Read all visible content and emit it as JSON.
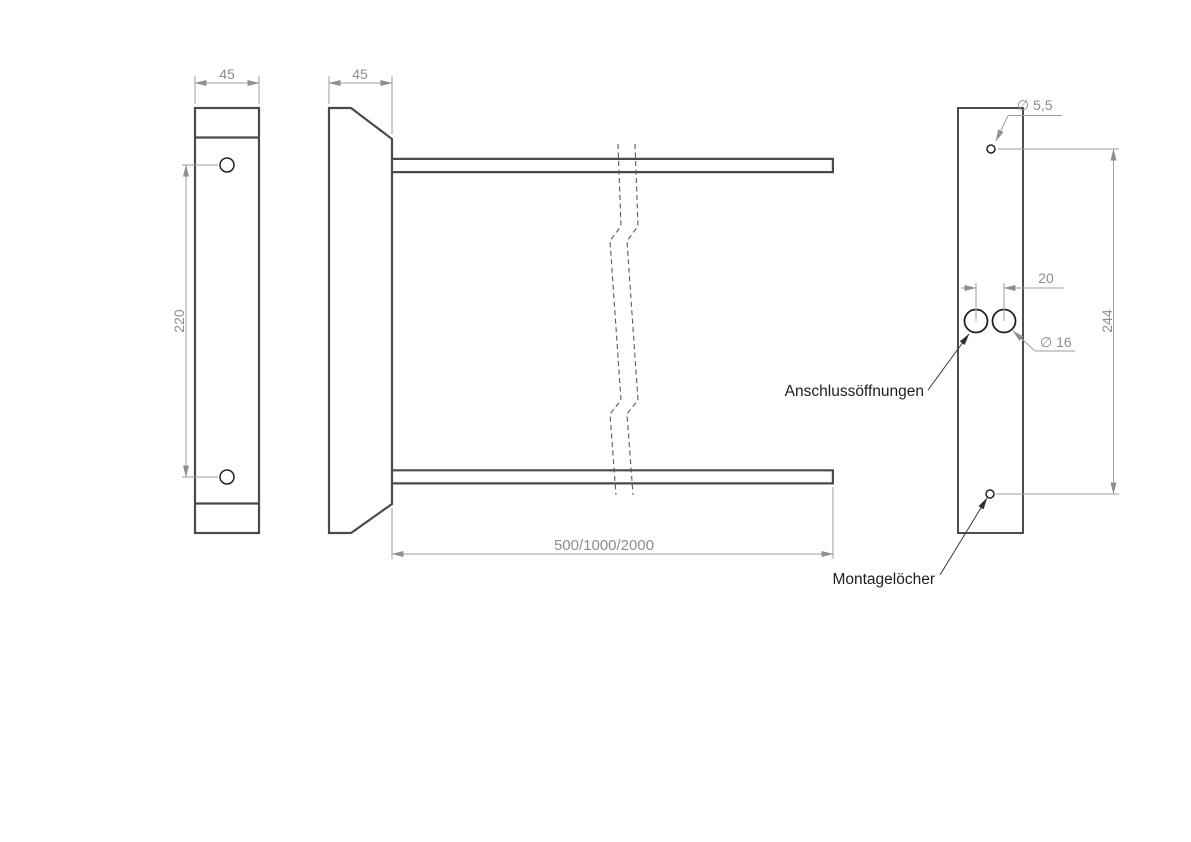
{
  "title": "technical-drawing-wall-bracket",
  "colors": {
    "background": "#ffffff",
    "part_outline": "#4a4a4a",
    "rear_outline": "#2e2e2e",
    "hole_stroke": "#222222",
    "dim_line": "#9e9e9e",
    "dim_text": "#8c8c8c",
    "break_line": "#5a5a5a",
    "callout_text": "#1d1d1d",
    "callout_line": "#3a3a3a"
  },
  "views": {
    "left_profile": {
      "width_dim": "45",
      "hole_spacing_dim": "220"
    },
    "side": {
      "depth_dim": "45",
      "length_dim": "500/1000/2000"
    },
    "rear_panel": {
      "mount_hole_dia_dim": "∅ 5,5",
      "port_spacing_dim": "20",
      "port_dia_dim": "∅ 16",
      "hole_span_dim": "244"
    }
  },
  "callouts": {
    "connection_ports": "Anschlussöffnungen",
    "mounting_holes": "Montagelöcher"
  }
}
